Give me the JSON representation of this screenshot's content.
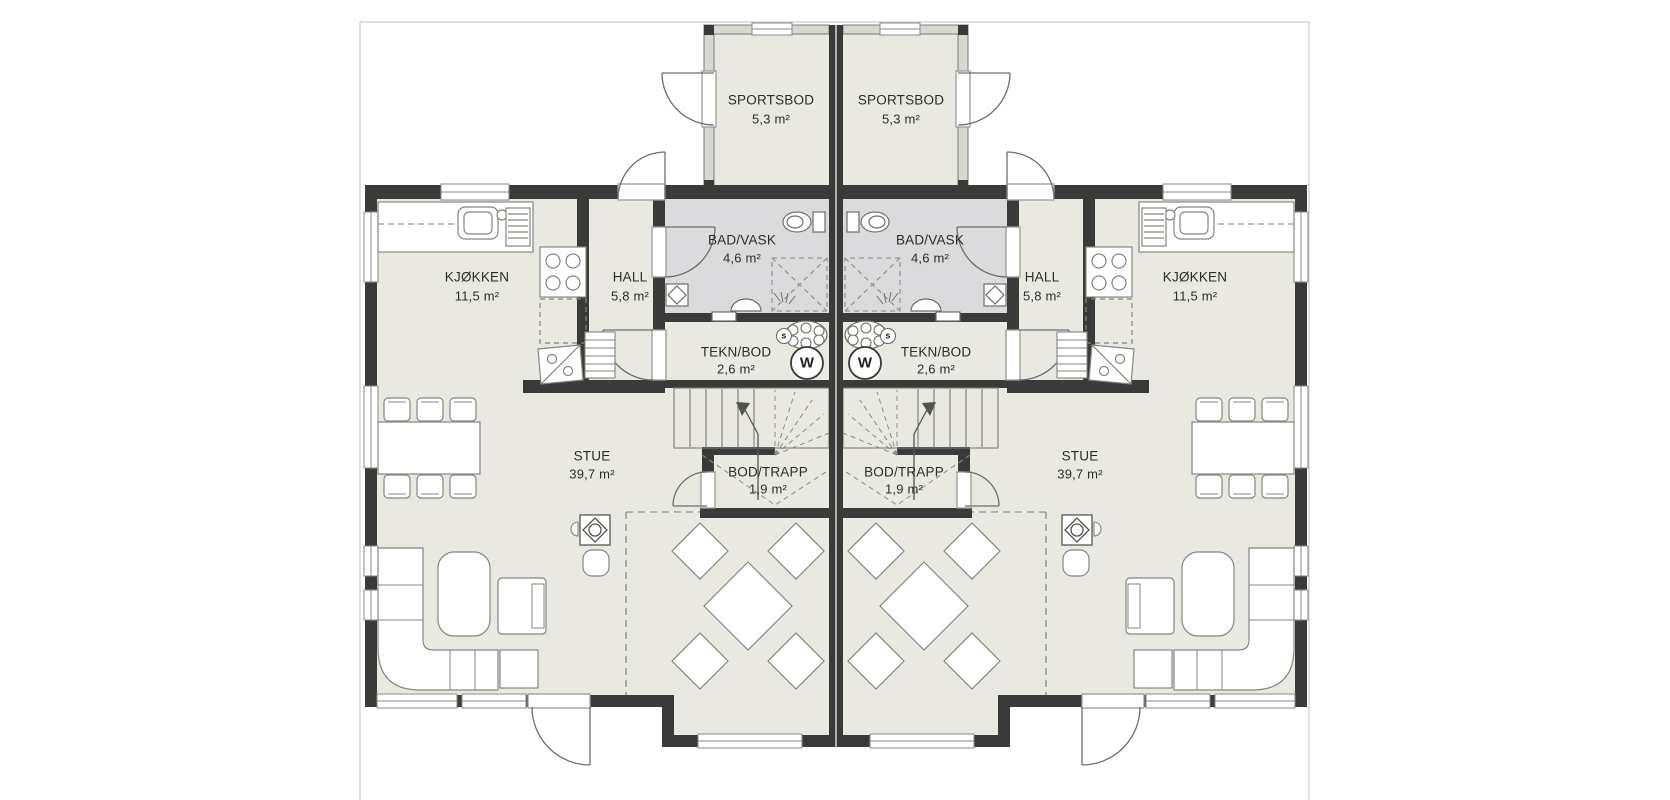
{
  "plan": {
    "rooms": {
      "sportsbod": {
        "name": "SPORTSBOD",
        "area": "5,3 m²"
      },
      "badvask": {
        "name": "BAD/VASK",
        "area": "4,6 m²"
      },
      "hall": {
        "name": "HALL",
        "area": "5,8 m²"
      },
      "kjokken": {
        "name": "KJØKKEN",
        "area": "11,5 m²"
      },
      "teknbod": {
        "name": "TEKN/BOD",
        "area": "2,6 m²"
      },
      "stue": {
        "name": "STUE",
        "area": "39,7 m²"
      },
      "bodtrapp": {
        "name": "BOD/TRAPP",
        "area": "1,9 m²"
      }
    },
    "appliances": {
      "washing_machine_label": "W",
      "water_heater_label": "s"
    },
    "colors": {
      "wall": "#3a3a38",
      "floor": "#e9e8e1",
      "bath_floor": "#dbdbdd",
      "outline": "#8a8a8a",
      "lot_border": "#cccccc"
    }
  }
}
